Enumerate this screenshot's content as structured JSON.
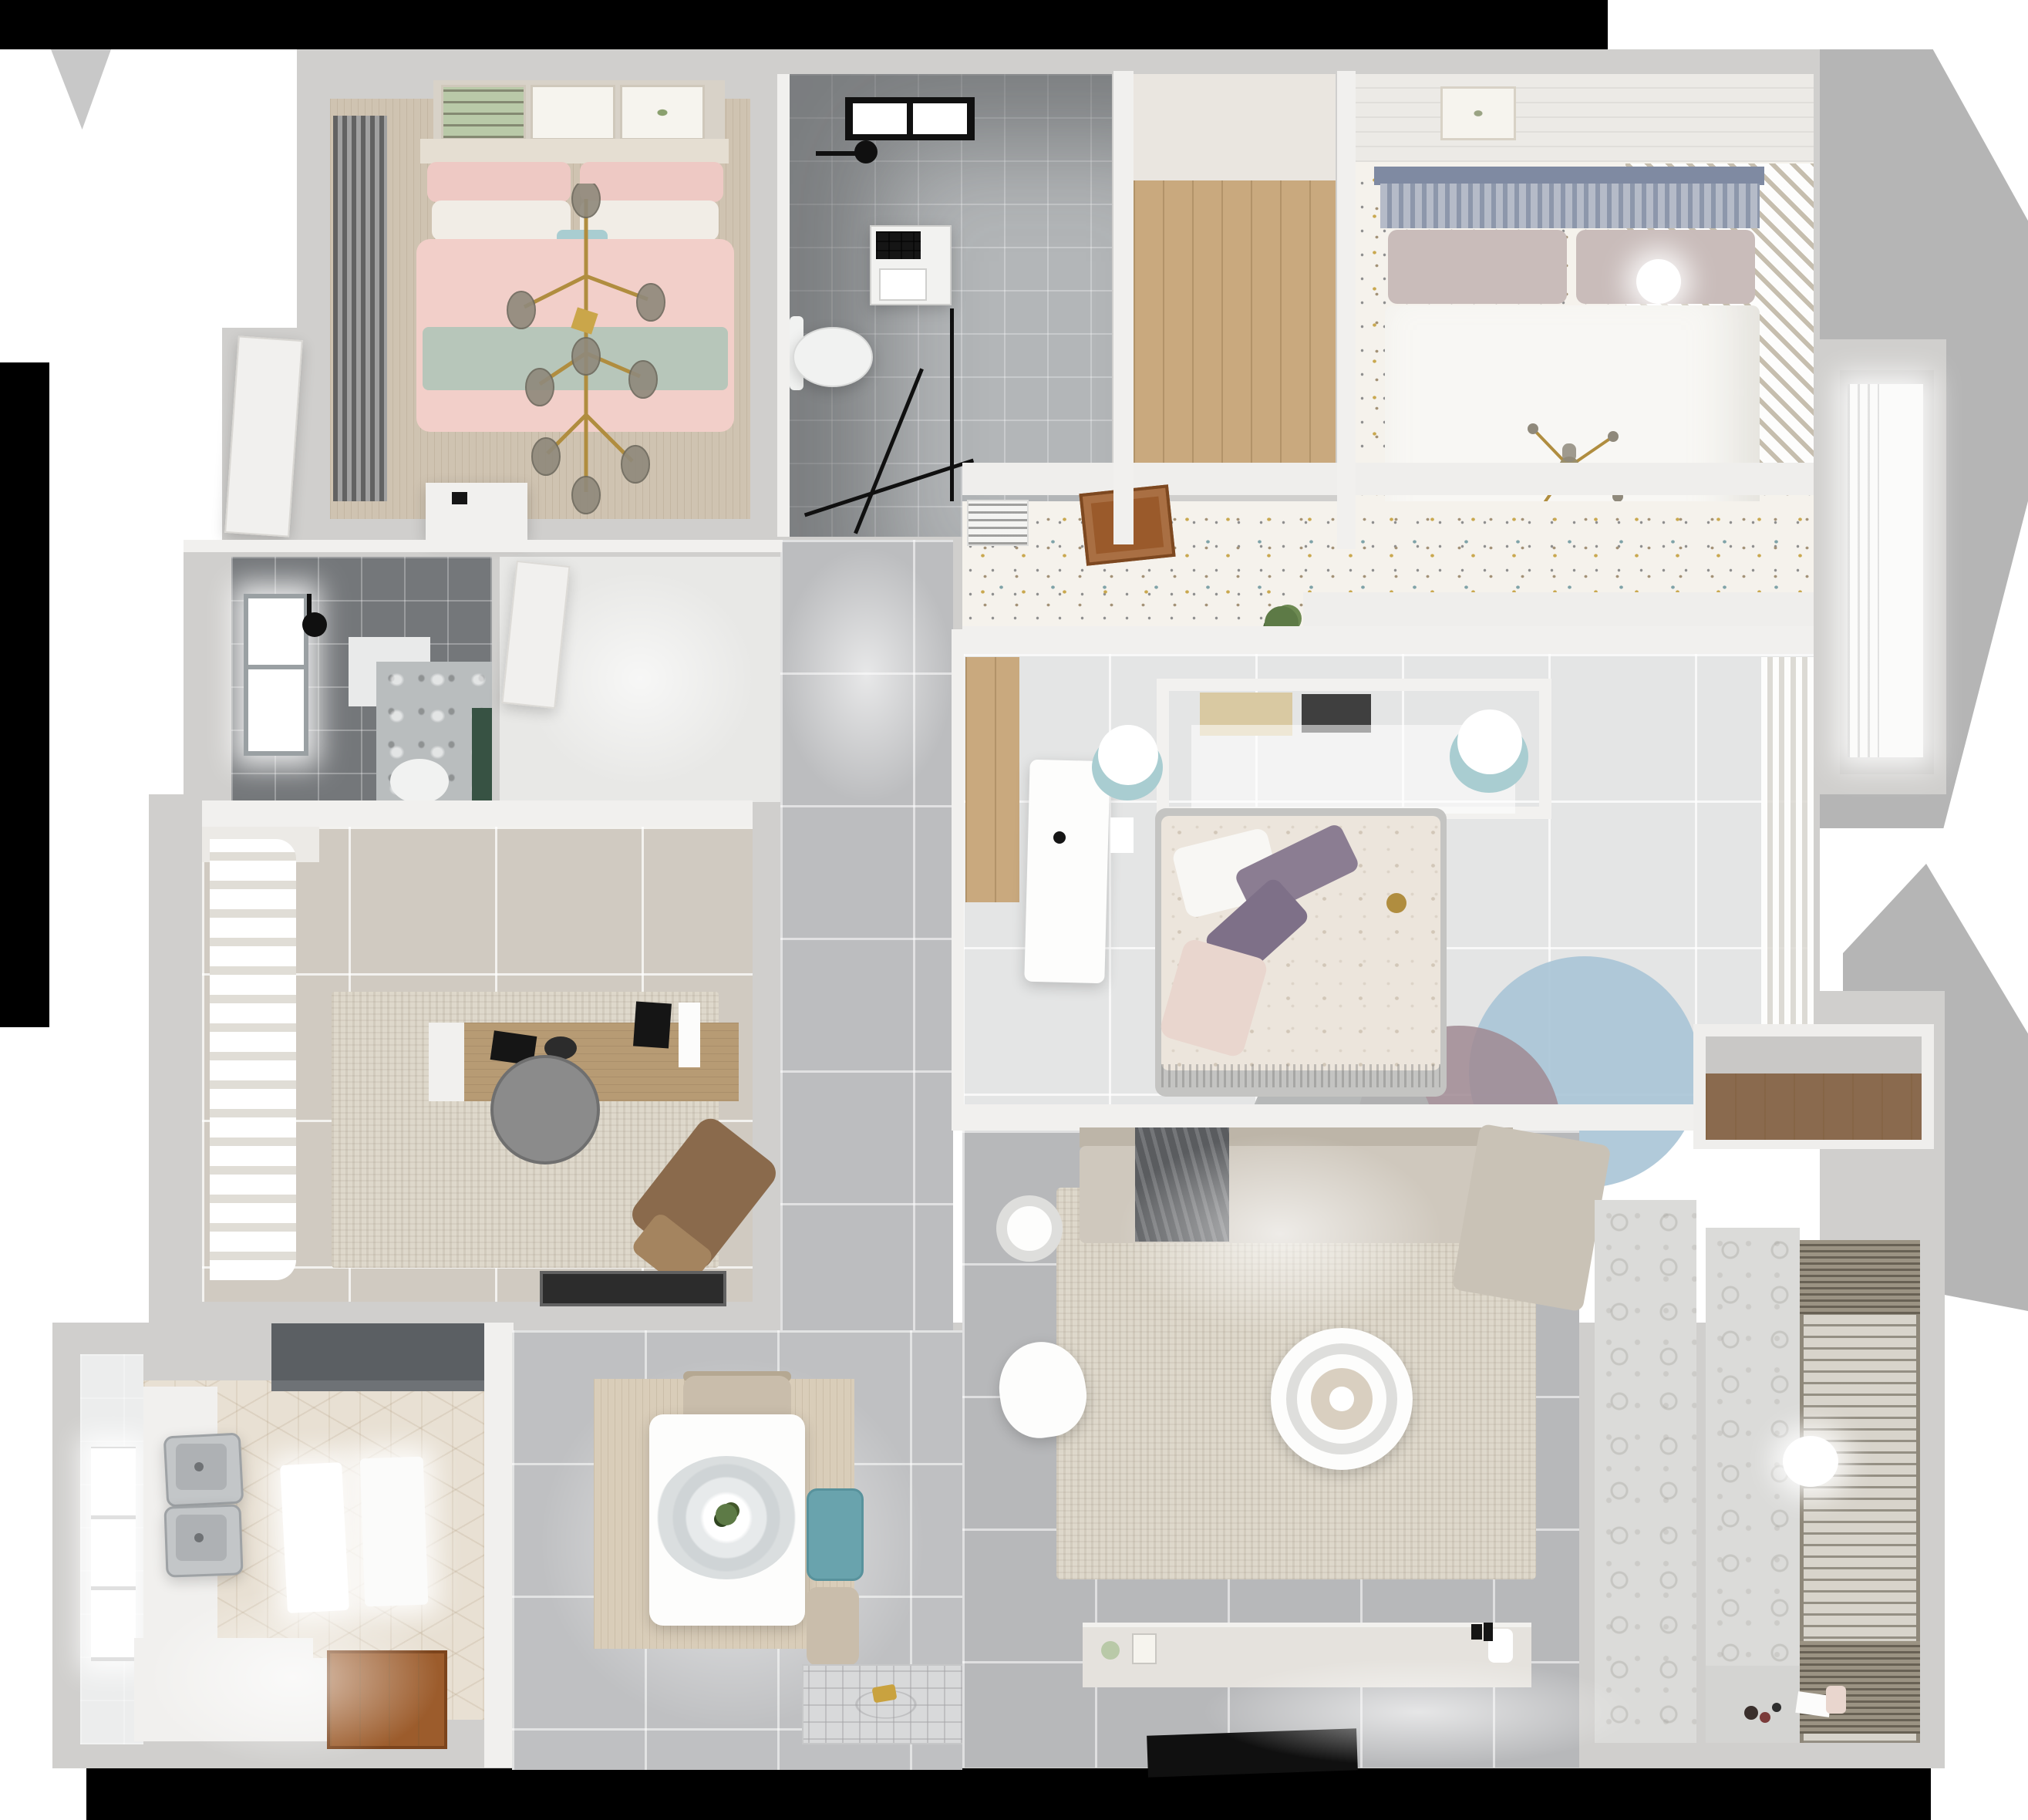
{
  "scene": {
    "type": "3d-floorplan-render",
    "view": "top-down dollhouse view of an apartment interior",
    "background": "#ffffff"
  },
  "rooms": [
    {
      "name": "bedroom-pink",
      "floor": "wood_warm",
      "items": [
        "double-bed-pink",
        "branch-chandelier",
        "dark-curtains",
        "wall-art-frames",
        "dresser"
      ]
    },
    {
      "name": "bathroom-top",
      "floor": "tile_gray",
      "items": [
        "shower",
        "washer",
        "toilet",
        "window"
      ]
    },
    {
      "name": "walkin-closet",
      "floor": "wood_plank",
      "items": []
    },
    {
      "name": "bedroom-white",
      "floor": "confetti_base",
      "items": [
        "double-bed-white",
        "slat-headboard",
        "cross-chandelier",
        "louver-wardrobe",
        "ball-lamp"
      ]
    },
    {
      "name": "upper-hallway",
      "floor": "confetti_base",
      "items": [
        "radiator-vent",
        "open-door-brown",
        "plant"
      ]
    },
    {
      "name": "bedroom-center",
      "floor": "tile_bed3",
      "items": [
        "double-bed-floral",
        "headboard-shelf",
        "stools",
        "round-rug-layers",
        "desk",
        "sheer-curtain"
      ]
    },
    {
      "name": "bathroom-dark",
      "floor": "tile_dark",
      "items": [
        "window",
        "shower-head",
        "mirror-cabinet",
        "toilet",
        "green-cabinet"
      ]
    },
    {
      "name": "corridor",
      "floor": "tile_hall",
      "items": []
    },
    {
      "name": "study",
      "floor": "tile_study",
      "items": [
        "wavy-curtain",
        "area-rug",
        "desk-wood",
        "office-chair",
        "lounge-chair",
        "doormat"
      ]
    },
    {
      "name": "kitchen",
      "floor": "hex_floor",
      "items": [
        "range-hood",
        "double-sink",
        "counters",
        "glow-boards",
        "entry-wood-door"
      ]
    },
    {
      "name": "dining",
      "floor": "tile_dining",
      "items": [
        "table",
        "pendant-lamp",
        "teal-chair",
        "beige-chairs",
        "wood-mat",
        "entry-mat"
      ]
    },
    {
      "name": "living-room",
      "floor": "tile_living",
      "items": [
        "l-sofa",
        "dark-throw",
        "cream-rug",
        "round-coffee-table",
        "tv-console",
        "tv",
        "armchair",
        "side-table"
      ]
    },
    {
      "name": "storage-niche",
      "floor": "wood_niche",
      "items": []
    },
    {
      "name": "balcony",
      "floor": "pattern_tile",
      "items": [
        "drying-rack",
        "ceiling-light",
        "toys"
      ]
    }
  ],
  "palette": {
    "black": "#000000",
    "white": "#ffffff",
    "shadow": "#b5b5b5",
    "shadow_soft": "#c8c8c8",
    "wall_outer": "#d0cfcd",
    "wall_inner": "#f1f0ee",
    "shelf_white": "#efeeec",
    "frame_band": "#d8d2c8",
    "frame_art": "#f6f4ee",
    "art_green": "#b9c9a8",
    "wood_warm": "#cfc3b1",
    "wood_plank": "#c9a97e",
    "wood_dark": "#9c5c2c",
    "wood_niche": "#8a6a4e",
    "wood_mat": "#d9cdb9",
    "headboard_wood": "#e5ded2",
    "tile_gray": "#b3b6b8",
    "tile_dark": "#74777a",
    "tile_hall": "#bcbdbf",
    "tile_living": "#b7b8ba",
    "tile_dining": "#bfc0c2",
    "tile_bed3": "#e4e5e5",
    "tile_study": "#d0cac1",
    "tile_kitchen_wall": "#eceded",
    "confetti_base": "#f5f2ec",
    "hex_floor": "#e8e0d3",
    "pink_duvet": "#f2cfc9",
    "pink_pillow": "#eec9c4",
    "sage": "#b7c6ba",
    "white_linen": "#f1ede6",
    "curtain_dark": "#8c8c8c",
    "curtain_sheer": "#f0eeea",
    "headboard_blue": "#8d97ab",
    "headboard_bar": "#7f8aa2",
    "mauve_pillow": "#c9bcba",
    "duvet_white": "#f8f7f4",
    "louver": "#d8d2c6",
    "panel_wall": "#eceae6",
    "closet_top": "#eae6e0",
    "bed3_duvet": "#ece5dc",
    "bed_base": "#c4c4c2",
    "purple": "#8b7d92",
    "purple_dark": "#7e7088",
    "blush": "#e9d6ce",
    "rug_blue": "#a9c4d6",
    "rug_mauve": "#a08a93",
    "rug_gray": "#b0b2b2",
    "stool_teal": "#a9cdd1",
    "book_tan": "#d9c9a2",
    "book_dark": "#3f3f3f",
    "sofa": "#cfc8bd",
    "sofa_back": "#bdb5a8",
    "sofa_chaise": "#c9c2b6",
    "throw_dark": "#5a5c5f",
    "rug_cream": "#ded8cb",
    "table_white": "#fdfdfc",
    "donut": "#d9cfc0",
    "console": "#e5e2dd",
    "tv_black": "#101010",
    "teal_chair": "#69a3ad",
    "beige_chair": "#c9bdab",
    "chair_back": "#b5a892",
    "mat": "#d8d9da",
    "gold": "#c9a23f",
    "hood": "#5b5f63",
    "sink": "#c3c6c8",
    "sink_inner": "#aeb1b4",
    "drain": "#6f7275",
    "counter": "#f1f0ee",
    "desk_wood": "#b79b74",
    "chair_gray": "#8b8b8b",
    "lounge": "#8a6a4c",
    "lounge_foot": "#a4845f",
    "matt_black": "#2c2c2c",
    "green_cab": "#375243",
    "washer": "#f2f2f0",
    "toilet": "#f1f2f1",
    "mirror_box": "#e9eaea",
    "marble": "#b9bdbe",
    "radiator": "#f4f4f2",
    "door_brown": "#9a5a2b",
    "plant": "#5d7a46",
    "brass": "#b08d3f",
    "globe": "#8f897b",
    "rack": "#d8d4cb",
    "rack_dense": "#9b9383",
    "pattern_tile": "#dbdbd9",
    "balcony_floor": "#d4d4d2",
    "niche_gray": "#c9c8c6",
    "hall_bright": "#e8e8e6",
    "paper": "#fcfcfb",
    "monitor": "#151515",
    "window_glow": "#fbfbfa",
    "light_white": "#ffffff"
  }
}
